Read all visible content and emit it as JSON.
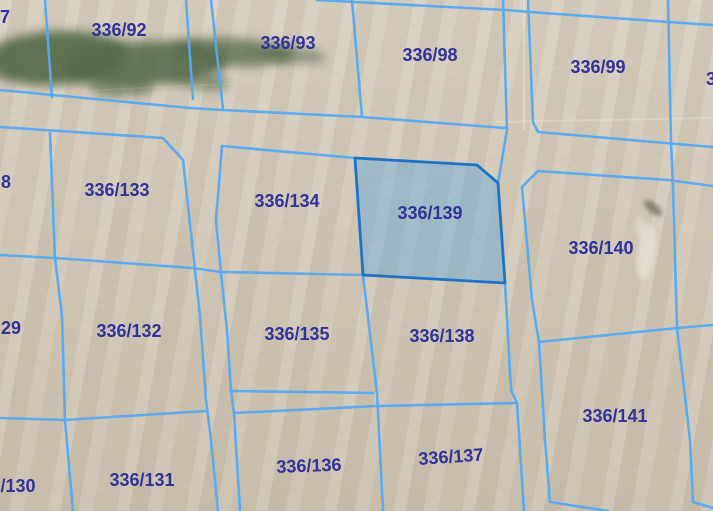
{
  "map": {
    "type": "cadastral-parcel-map",
    "selected_parcel_label": "336/139",
    "canvas": {
      "width": 713,
      "height": 511
    },
    "colors": {
      "background": "#d2c8b6",
      "boundary": "#54a9f2",
      "highlight_outline": "#1b74c8",
      "highlight_fill": "rgba(100,170,220,0.45)",
      "label": "#32329b",
      "vegetation": "#55694a",
      "field_line": "#e9e3d6"
    },
    "parcel_labels": [
      {
        "text": "7",
        "x": 5,
        "y": 18,
        "rot": 0
      },
      {
        "text": "336/92",
        "x": 119,
        "y": 31,
        "rot": 0
      },
      {
        "text": "336/93",
        "x": 288,
        "y": 44,
        "rot": 0
      },
      {
        "text": "336/98",
        "x": 430,
        "y": 56,
        "rot": 0
      },
      {
        "text": "336/99",
        "x": 598,
        "y": 68,
        "rot": 0
      },
      {
        "text": "3",
        "x": 711,
        "y": 80,
        "rot": 0
      },
      {
        "text": "8",
        "x": 6,
        "y": 183,
        "rot": 0
      },
      {
        "text": "336/133",
        "x": 117,
        "y": 191,
        "rot": 0
      },
      {
        "text": "336/134",
        "x": 287,
        "y": 202,
        "rot": 0
      },
      {
        "text": "336/139",
        "x": 430,
        "y": 214,
        "rot": 0
      },
      {
        "text": "336/140",
        "x": 601,
        "y": 249,
        "rot": 0
      },
      {
        "text": "29",
        "x": 11,
        "y": 329,
        "rot": 0
      },
      {
        "text": "336/132",
        "x": 129,
        "y": 332,
        "rot": 0
      },
      {
        "text": "336/135",
        "x": 297,
        "y": 335,
        "rot": 0
      },
      {
        "text": "336/138",
        "x": 442,
        "y": 337,
        "rot": 0
      },
      {
        "text": "336/141",
        "x": 615,
        "y": 417,
        "rot": 0
      },
      {
        "text": "/130",
        "x": 18,
        "y": 487,
        "rot": 0
      },
      {
        "text": "336/131",
        "x": 142,
        "y": 481,
        "rot": 0
      },
      {
        "text": "336/136",
        "x": 309,
        "y": 467,
        "rot": -2
      },
      {
        "text": "336/137",
        "x": 451,
        "y": 458,
        "rot": -4
      }
    ],
    "boundary_lines": [
      {
        "name": "top-right-strip-edge",
        "points": "317,0 505,10 530,12 668,22 713,25"
      },
      {
        "name": "parcel-93-98-divider",
        "points": "352,0 362,117"
      },
      {
        "name": "parcel-7-92-divider",
        "points": "45,0 52,97"
      },
      {
        "name": "parcel-92-right-edge",
        "points": "186,0 193,99"
      },
      {
        "name": "parcel-93-left-edge",
        "points": "211,0 223,109"
      },
      {
        "name": "top-strip-bottom-edge",
        "points": "0,90 190,108 223,110 362,117 505,128"
      },
      {
        "name": "corridor-98-right-edge",
        "points": "503,0 507,130 498,183"
      },
      {
        "name": "parcel-99-left-bottom-edge",
        "points": "528,0 533,122 538,132 665,143 713,147"
      },
      {
        "name": "parcel-140-top-edge",
        "points": "522,187 538,171 668,180 713,186"
      },
      {
        "name": "right-block-left-edge",
        "points": "522,187 532,300 539,342 545,440 550,502 608,511"
      },
      {
        "name": "right-main-vertical",
        "points": "668,0 671,143 673,186 677,328 690,440 693,502 713,508"
      },
      {
        "name": "parcel-140-141-divider",
        "points": "539,342 677,328 713,325"
      },
      {
        "name": "middle-block-top-edge",
        "points": "222,146 355,158"
      },
      {
        "name": "middle-block-left-edge",
        "points": "222,146 216,220 221,273 227,330 231,391 234,413 240,511"
      },
      {
        "name": "left-block-outline",
        "points": "0,127 163,138 183,160 193,252 200,316 206,400 211,440 218,511"
      },
      {
        "name": "left-edge-parcels-divider",
        "points": "50,133 55,258 62,316 65,420 73,511"
      },
      {
        "name": "row1-row2-divider",
        "points": "0,255 55,258 192,268 221,272 363,275"
      },
      {
        "name": "parcel-132-131-divider",
        "points": "0,418 65,420 206,411"
      },
      {
        "name": "parcel-135-bottom-edge",
        "points": "231,391 373,393"
      },
      {
        "name": "parcel-136-137-top-edge",
        "points": "234,413 377,406 517,403"
      },
      {
        "name": "parcel-135-138-divider",
        "points": "363,275 377,393 383,511"
      },
      {
        "name": "middle-block-right-edge",
        "points": "505,283 511,390 517,403 524,511"
      }
    ],
    "highlighted_parcel": {
      "label": "336/139",
      "points": "355,158 477,165 498,183 505,283 363,275"
    },
    "vegetation_patches": [
      {
        "cx": 55,
        "cy": 58,
        "rx": 72,
        "ry": 27,
        "rot": -3,
        "opacity": 0.9
      },
      {
        "cx": 145,
        "cy": 63,
        "rx": 82,
        "ry": 22,
        "rot": -2,
        "opacity": 0.85
      },
      {
        "cx": 232,
        "cy": 52,
        "rx": 62,
        "ry": 14,
        "rot": 3,
        "opacity": 0.75
      },
      {
        "cx": 295,
        "cy": 55,
        "rx": 32,
        "ry": 8,
        "rot": 5,
        "opacity": 0.55
      },
      {
        "cx": 120,
        "cy": 86,
        "rx": 34,
        "ry": 11,
        "rot": 0,
        "opacity": 0.6
      },
      {
        "cx": 200,
        "cy": 80,
        "rx": 30,
        "ry": 10,
        "rot": 8,
        "opacity": 0.55
      }
    ],
    "ground_marks": [
      {
        "cx": 653,
        "cy": 208,
        "rx": 11,
        "ry": 5,
        "rot": 40,
        "fill": "#6b655a",
        "opacity": 0.65
      },
      {
        "cx": 646,
        "cy": 252,
        "rx": 9,
        "ry": 28,
        "rot": 8,
        "fill": "#e6e0d4",
        "opacity": 0.8
      },
      {
        "cx": 641,
        "cy": 227,
        "rx": 6,
        "ry": 10,
        "rot": -6,
        "fill": "#e2dccf",
        "opacity": 0.7
      },
      {
        "cx": 400,
        "cy": 188,
        "rx": 28,
        "ry": 10,
        "rot": -4,
        "fill": "#dcd4c6",
        "opacity": 0.35
      }
    ],
    "field_lines": [
      {
        "points": "524,0 524,130",
        "opacity": 0.55
      },
      {
        "points": "495,122 713,118",
        "opacity": 0.45
      },
      {
        "points": "0,95 713,60",
        "opacity": 0.12
      }
    ]
  }
}
